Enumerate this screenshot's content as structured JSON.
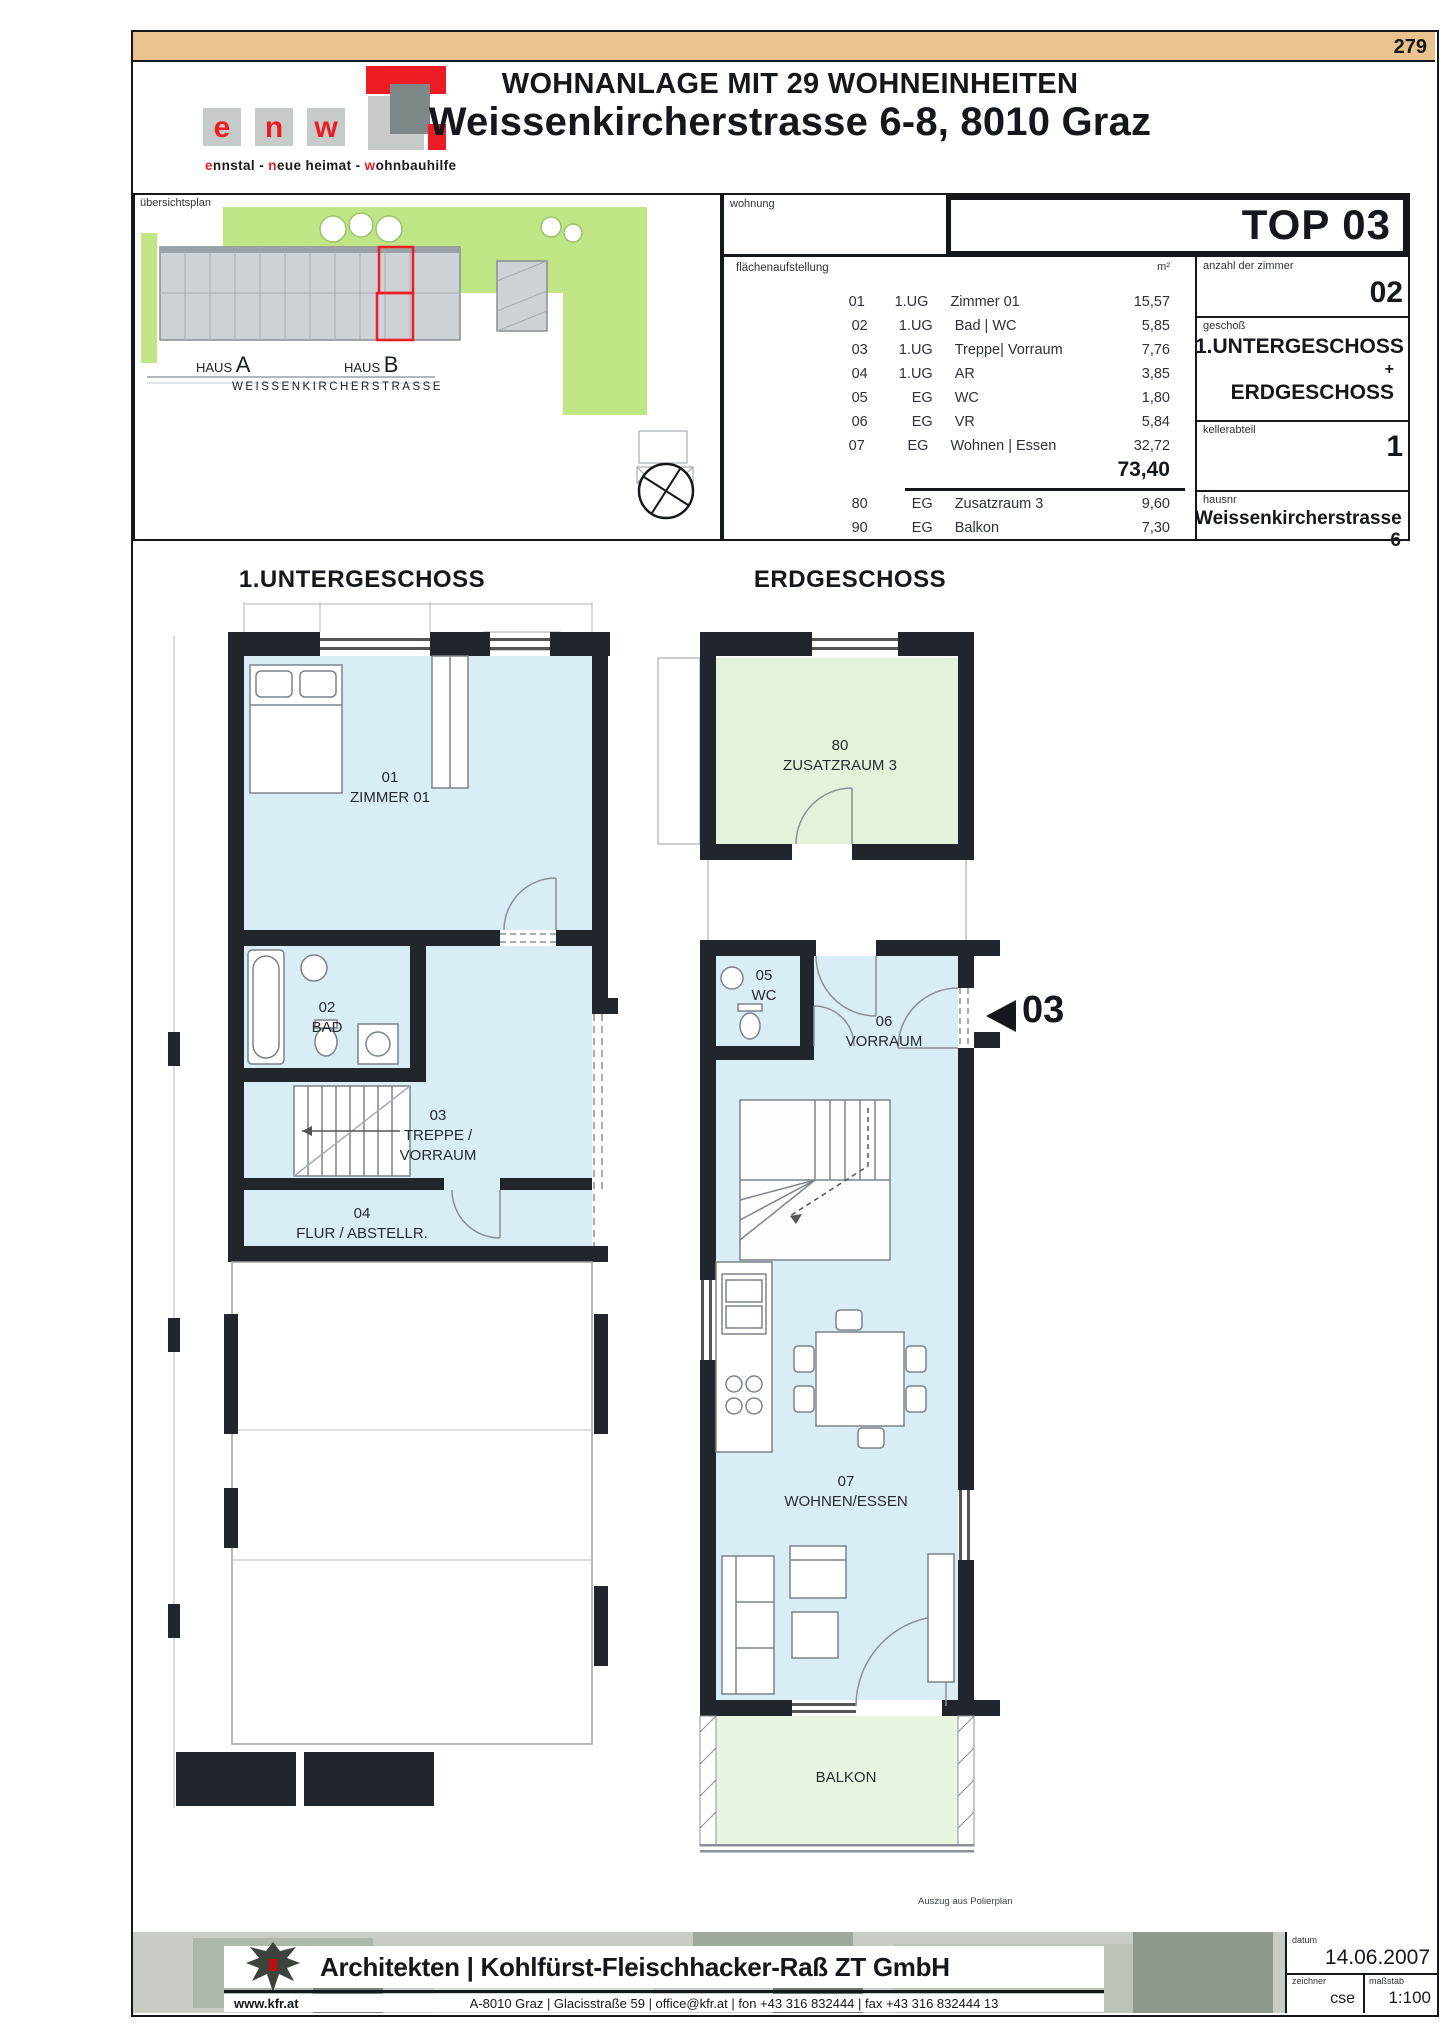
{
  "page": {
    "number": "279"
  },
  "header": {
    "title_line1": "WOHNANLAGE MIT 29 WOHNEINHEITEN",
    "title_line2": "Weissenkircherstrasse 6-8, 8010 Graz"
  },
  "logo": {
    "l1": "e",
    "l2": "n",
    "l3": "w",
    "tagline": {
      "p1": "e",
      "p2": "nnstal - ",
      "p3": "n",
      "p4": "eue heimat - ",
      "p5": "w",
      "p6": "ohnbauhilfe"
    }
  },
  "site_plan": {
    "label": "übersichtsplan",
    "haus_prefix": "HAUS",
    "haus_a": "A",
    "haus_b": "B",
    "street": "WEISSENKIRCHERSTRASSE"
  },
  "wohnung": {
    "label": "wohnung",
    "top": "TOP 03"
  },
  "area_table": {
    "label": "flächenaufstellung",
    "unit": "m²",
    "rows": [
      {
        "nr": "01",
        "level": "1.UG",
        "name": "Zimmer 01",
        "area": "15,57"
      },
      {
        "nr": "02",
        "level": "1.UG",
        "name": "Bad | WC",
        "area": "5,85"
      },
      {
        "nr": "03",
        "level": "1.UG",
        "name": "Treppe| Vorraum",
        "area": "7,76"
      },
      {
        "nr": "04",
        "level": "1.UG",
        "name": "AR",
        "area": "3,85"
      },
      {
        "nr": "05",
        "level": "EG",
        "name": "WC",
        "area": "1,80"
      },
      {
        "nr": "06",
        "level": "EG",
        "name": "VR",
        "area": "5,84"
      },
      {
        "nr": "07",
        "level": "EG",
        "name": "Wohnen | Essen",
        "area": "32,72"
      }
    ],
    "total": "73,40",
    "extra_rows": [
      {
        "nr": "80",
        "level": "EG",
        "name": "Zusatzraum 3",
        "area": "9,60"
      },
      {
        "nr": "90",
        "level": "EG",
        "name": "Balkon",
        "area": "7,30"
      }
    ]
  },
  "details": {
    "zimmer_label": "anzahl der zimmer",
    "zimmer_value": "02",
    "geschoss_label": "geschoß",
    "geschoss_value1": "1.UNTERGESCHOSS",
    "geschoss_plus": "+",
    "geschoss_value2": "ERDGESCHOSS",
    "keller_label": "kellerabteil",
    "keller_value": "1",
    "hausnr_label": "hausnr",
    "hausnr_value": "Weissenkircherstrasse 6"
  },
  "plans": {
    "ug": {
      "heading": "1.UNTERGESCHOSS",
      "rooms": [
        {
          "nr": "01",
          "name": "ZIMMER 01"
        },
        {
          "nr": "02",
          "name": "BAD"
        },
        {
          "nr": "03",
          "name": "TREPPE /",
          "name2": "VORRAUM"
        },
        {
          "nr": "04",
          "name": "FLUR / ABSTELLR."
        }
      ]
    },
    "eg": {
      "heading": "ERDGESCHOSS",
      "rooms": [
        {
          "nr": "80",
          "name": "ZUSATZRAUM 3"
        },
        {
          "nr": "05",
          "name": "WC"
        },
        {
          "nr": "06",
          "name": "VORRAUM"
        },
        {
          "nr": "07",
          "name": "WOHNEN/ESSEN"
        }
      ],
      "balkon": "BALKON",
      "unit_marker": "03",
      "note": "Auszug aus Polierplan"
    }
  },
  "footer": {
    "firm": "Architekten | Kohlfürst-Fleischhacker-Raß ZT GmbH",
    "website": "www.kfr.at",
    "address": "A-8010 Graz  |  Glacisstraße 59  |  office@kfr.at  |  fon +43 316 832444  |  fax +43 316 832444 13",
    "datum_label": "datum",
    "datum_value": "14.06.2007",
    "zeichner_label": "zeichner",
    "zeichner_value": "cse",
    "massstab_label": "maßstab",
    "massstab_value": "1:100"
  },
  "colors": {
    "accent_red": "#ed1c24",
    "tan": "#e9c28e",
    "room_blue": "#d8edf6",
    "site_green": "#bfe584",
    "room_green": "#e4f2d9",
    "balkon_green": "#e9f5e0",
    "wall": "#20262b"
  }
}
